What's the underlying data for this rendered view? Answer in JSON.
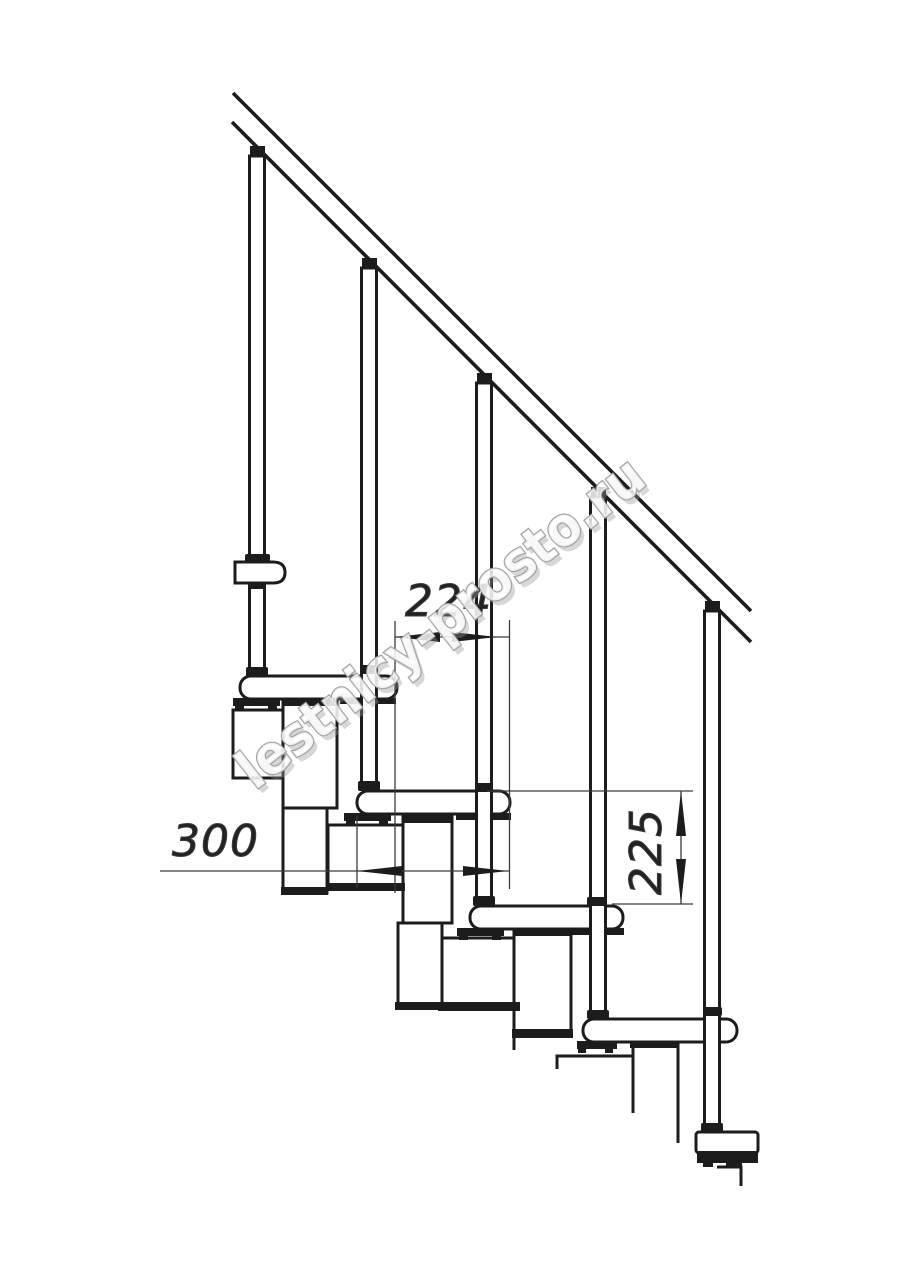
{
  "watermark": {
    "text": "lestnicy-prosto.ru"
  },
  "dimensions": {
    "step_run": {
      "value": "224",
      "orientation": "horizontal"
    },
    "tread_length": {
      "value": "300",
      "orientation": "horizontal"
    },
    "step_rise": {
      "value": "225",
      "orientation": "vertical"
    }
  },
  "colors": {
    "line": "#1c1c1c",
    "dimension": "#3c3c3c",
    "dim_text": "#222222",
    "watermark_stroke": "#a2a2a2",
    "background": "#ffffff"
  }
}
